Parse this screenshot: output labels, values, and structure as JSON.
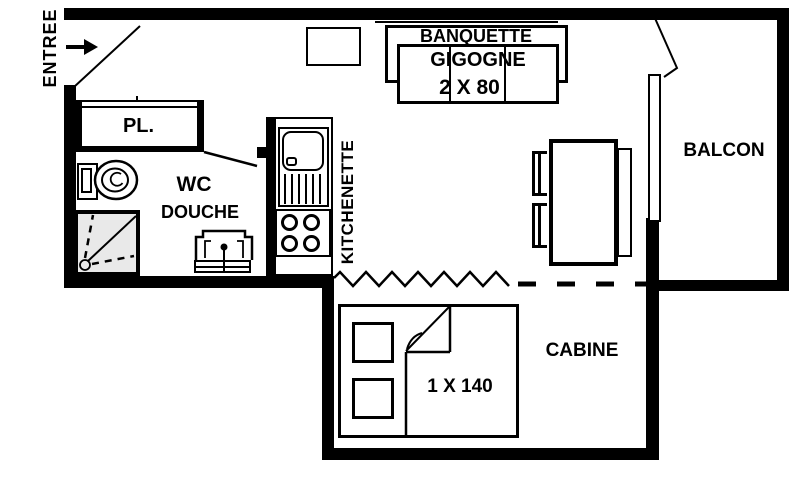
{
  "floorplan": {
    "entry": {
      "label": "ENTREE"
    },
    "closet": {
      "label": "PL."
    },
    "bathroom": {
      "wc_label": "WC",
      "shower_label": "DOUCHE"
    },
    "kitchen": {
      "label": "KITCHENETTE"
    },
    "living": {
      "banquette_label": "BANQUETTE",
      "banquette_type": "GIGOGNE",
      "banquette_size": "2 X 80"
    },
    "balcony": {
      "label": "BALCON"
    },
    "cabin": {
      "label": "CABINE",
      "bed_size": "1 X 140"
    },
    "colors": {
      "ink": "#000000",
      "background": "#ffffff",
      "shower_fill": "#e9e9e9"
    }
  }
}
